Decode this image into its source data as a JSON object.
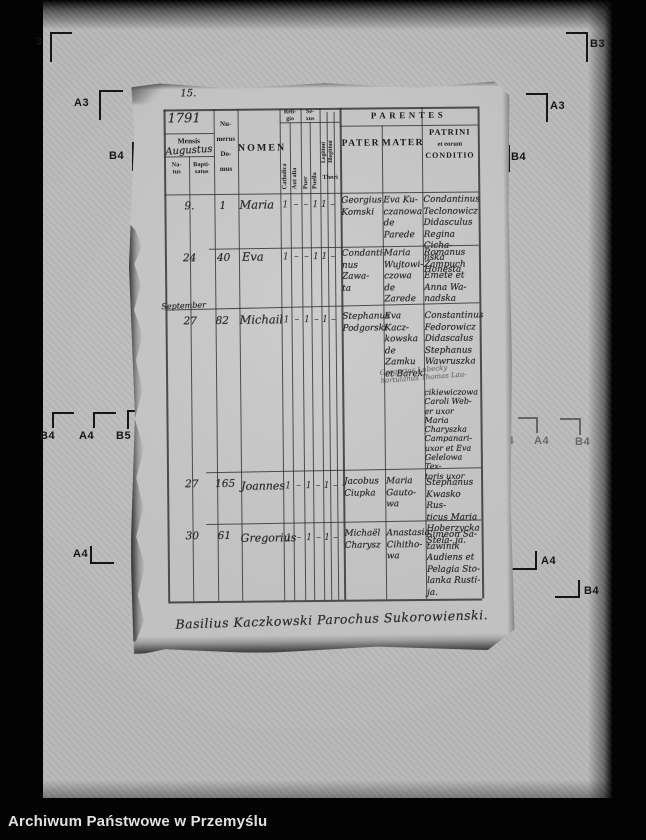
{
  "caption": "Archiwum Państwowe w Przemyślu",
  "colors": {
    "background": "#000000",
    "film": "#b9b9b9",
    "paper": "#c7c7c7",
    "ink": "#2d2d2d",
    "caption": "#e2e2e2"
  },
  "fiducials": [
    "3",
    "B3",
    "A3",
    "A3",
    "B4",
    "B4",
    "B4",
    "A4",
    "B5",
    "B4",
    "A4",
    "B4",
    "A4",
    "A4",
    "B4"
  ],
  "page": {
    "page_number": "15.",
    "year": "1791",
    "month": "Augustus",
    "signature": "Basilius Kaczkowski Parochus Sukorowienski.",
    "header": {
      "mensis": "Mensis",
      "natus": "Na-\ntus",
      "baptisatus": "Bapti-\nsatus",
      "numerus": "Nu-\nmerus\nDo-\nmus",
      "nomen": "NOMEN",
      "religio": "Reli-\ngio",
      "catholica": "Catholica",
      "aut_alia": "Aut alia",
      "sexus": "Se-\nxus",
      "puer": "Puer",
      "puella": "Puella",
      "legitimi": "Legitimi",
      "illegitimi": "Illegitimi",
      "thori": "Thori",
      "parentes": "PARENTES",
      "pater": "PATER",
      "mater": "MATER",
      "patrini_title": "PATRINI",
      "patrini_sub": "et eorum",
      "patrini_cond": "CONDITIO"
    },
    "rows": [
      {
        "mensis": "",
        "natus": "9.",
        "domus": "1",
        "nomen": "Maria",
        "marks": [
          "1",
          "–",
          "–",
          "1",
          "1",
          "–"
        ],
        "pater": "Georgius\nKomski",
        "mater": "Eva Ku-\nczanowa\nde Parede",
        "patrini": "Condantinus\nTeclonowicz\nDidasculus\nRegina Cicha-\nnska Honesta"
      },
      {
        "mensis": "",
        "natus": "24",
        "domus": "40",
        "nomen": "Eva",
        "marks": [
          "1",
          "–",
          "–",
          "1",
          "1",
          "–"
        ],
        "pater": "Condanti-\nnus Zawa-\nta",
        "mater": "Maria\nWujtowi-\nczowa de\nZarede",
        "patrini": "Romanus\nZampuch\nEmete et\nAnna Wa-\nnadska"
      },
      {
        "mensis": "September",
        "natus": "27",
        "domus": "82",
        "nomen": "Michail",
        "marks": [
          "1",
          "–",
          "1",
          "–",
          "1",
          "–"
        ],
        "pater": "Stephanus\nPodgorski",
        "mater": "Eva Kacz-\nkowska\nde Zamku\net Barek",
        "patrini": "Constantinus\nFedorowicz\nDidascalus\nStephanus\nWawruszka",
        "patrini_note": "Gregorius Lubecky\nhortulanus Thomas Lau-",
        "patrini_cont": "cikiewiczowa\nCaroli Web-\ner uxor Maria\nCharyszka\nCampanari-\nuxor et Eva\nGelelowa Tex-\ntoris uxor"
      },
      {
        "mensis": "",
        "natus": "27",
        "domus": "165",
        "nomen": "Joannes",
        "marks": [
          "1",
          "–",
          "1",
          "–",
          "1",
          "–"
        ],
        "pater": "Jacobus\nCiupka",
        "mater": "Maria\nGauto-\nwa",
        "patrini": "Stephanus\nKwasko Rus-\nticus Maria\nHoberzycka\nStela- ja."
      },
      {
        "mensis": "",
        "natus": "30",
        "domus": "61",
        "nomen": "Gregorius",
        "marks": [
          "1",
          "–",
          "1",
          "–",
          "1",
          "–"
        ],
        "pater": "Michaël\nCharysz",
        "mater": "Anastasia\nCihitho-\nwa",
        "patrini": "Simeon Sa-\ntawinik\nAudiens et\nPelagia Sto-\nlanka Rusti-\nja."
      }
    ]
  }
}
